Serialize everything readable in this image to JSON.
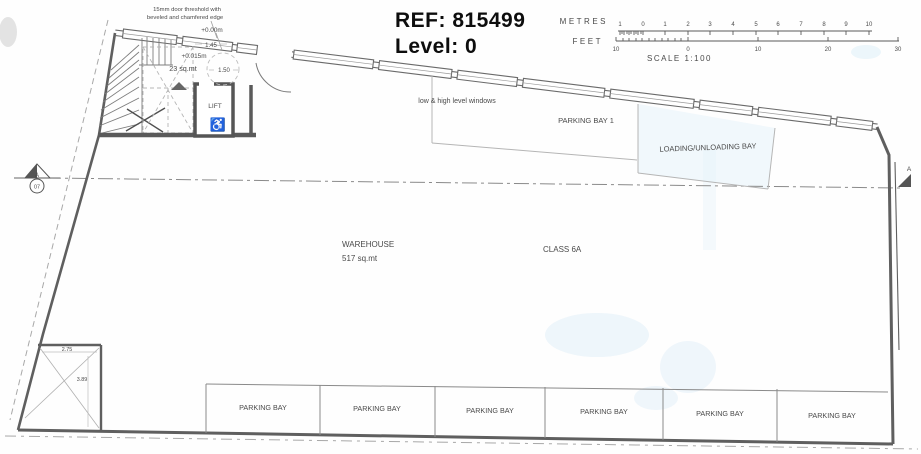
{
  "header": {
    "ref": "REF: 815499",
    "level": "Level: 0"
  },
  "scalebar": {
    "metres_label": "METRES",
    "feet_label": "FEET",
    "scale_label": "SCALE 1:100",
    "metres_ticks": [
      "1",
      "0",
      "1",
      "2",
      "3",
      "4",
      "5",
      "6",
      "7",
      "8",
      "9",
      "10"
    ],
    "feet_ticks": [
      "10",
      "0",
      "10",
      "20",
      "30"
    ]
  },
  "annotations": {
    "threshold_note_line1": "15mm door threshold with",
    "threshold_note_line2": "beveled and chamfered edge",
    "level_datum": "+0.00m",
    "level_threshold": "+0.015m",
    "stair_area": "23 sq.mt",
    "dim_door_width": "1.45",
    "dim_turning_circle": "1.50",
    "windows_note": "low & high level windows",
    "lift_label": "LIFT",
    "dim_store_width": "2.75",
    "dim_store_depth": "3.89"
  },
  "rooms": {
    "warehouse_name": "WAREHOUSE",
    "warehouse_area": "517 sq.mt",
    "class_label": "CLASS 6A",
    "parking_bay_1": "PARKING BAY 1",
    "loading_bay": "LOADING/UNLOADING BAY",
    "parking_bays": [
      "PARKING BAY",
      "PARKING BAY",
      "PARKING BAY",
      "PARKING BAY",
      "PARKING BAY",
      "PARKING BAY"
    ]
  },
  "markers": {
    "section_letter": "A",
    "section_number": "07",
    "section_letter_right": "A"
  },
  "icons": {
    "wheelchair_icon": "♿"
  },
  "colors": {
    "wall": "#5f5f5f",
    "faint_line": "#b5b5b5",
    "text": "#4a4a4a",
    "artifact_blue": "#ddeef8"
  }
}
